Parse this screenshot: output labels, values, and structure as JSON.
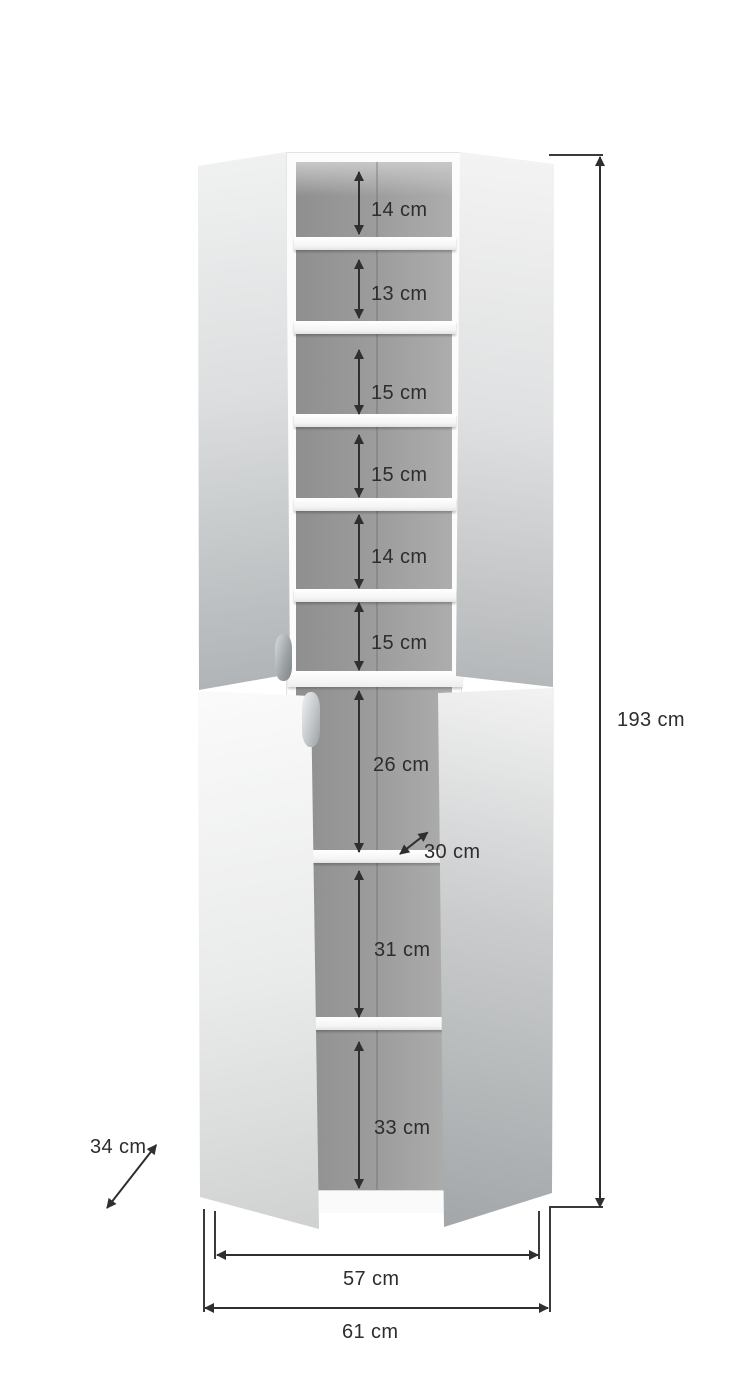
{
  "diagram": {
    "subject": "Tall cabinet with open doors and interior shelf dimensions",
    "unit": "cm",
    "colors": {
      "background": "#ffffff",
      "dimension_lines": "#2f2f2f",
      "interior_back": "#9a9a9a",
      "carcass": "#fcfcfc"
    },
    "upper_shelf_gaps": [
      "14 cm",
      "13 cm",
      "15 cm",
      "15 cm",
      "14 cm",
      "15 cm"
    ],
    "lower_shelf_gaps": [
      "26 cm",
      "31 cm",
      "33 cm"
    ],
    "shelf_depth": "30 cm",
    "total_height": "193 cm",
    "total_depth": "34 cm",
    "inner_width": "57 cm",
    "outer_width": "61 cm"
  }
}
